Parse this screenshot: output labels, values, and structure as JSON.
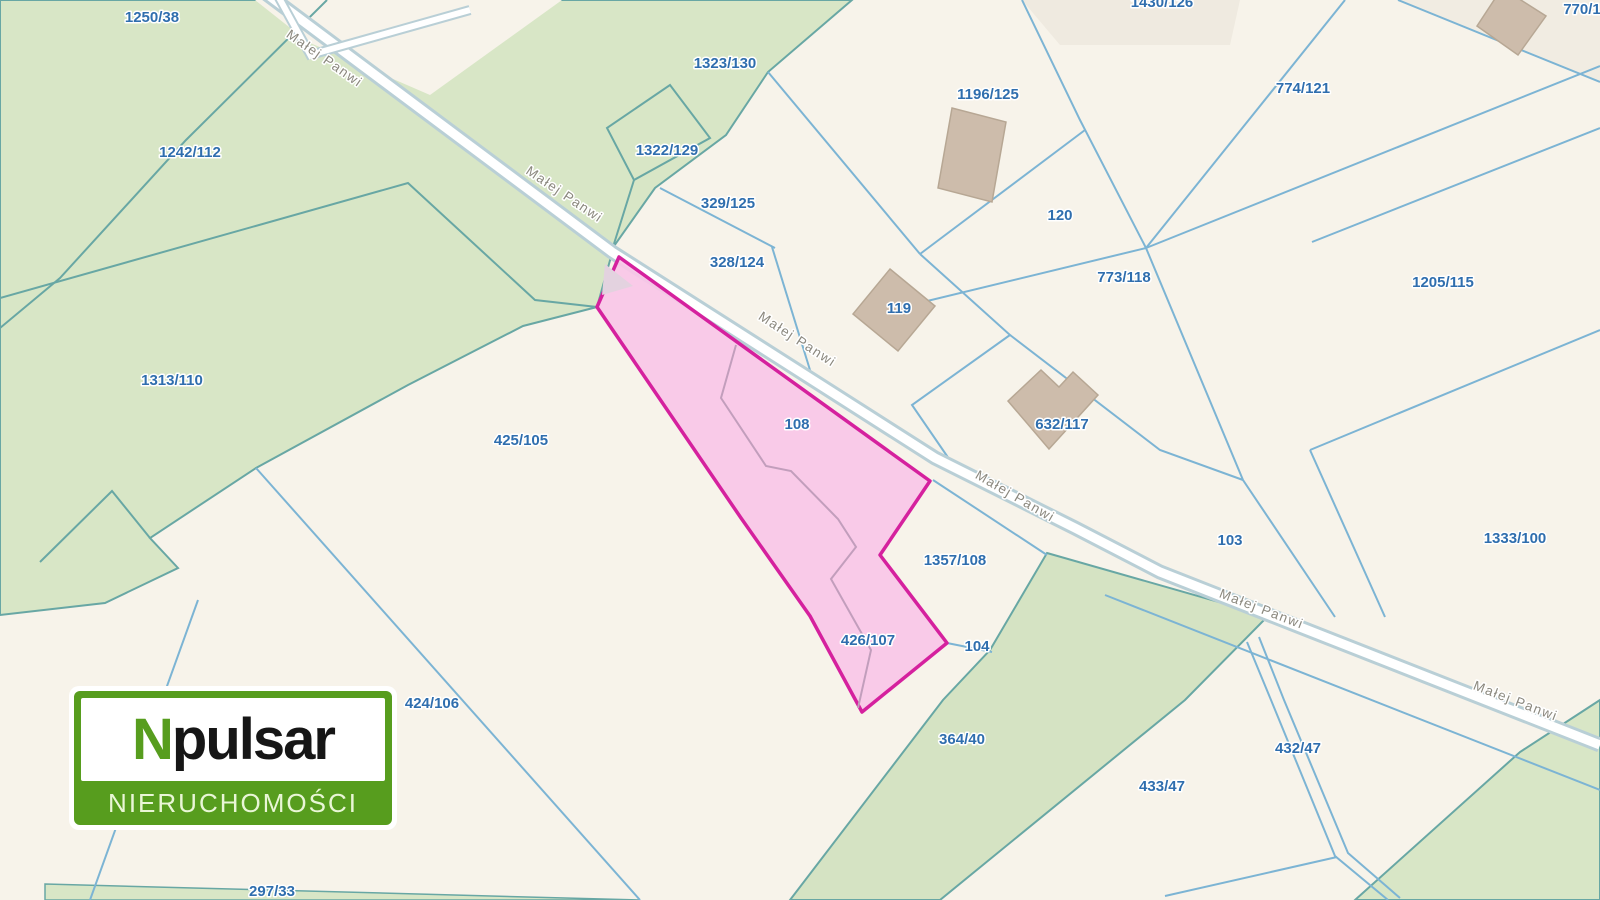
{
  "map": {
    "road_name": "Małej Panwi",
    "parcels": {
      "p1250_38": "1250/38",
      "p1242_112": "1242/112",
      "p1313_110": "1313/110",
      "p1323_130": "1323/130",
      "p1322_129": "1322/129",
      "p329_125": "329/125",
      "p328_124": "328/124",
      "p1196_125": "1196/125",
      "p1430_126": "1430/126",
      "p770_1": "770/1",
      "p774_121": "774/121",
      "p120": "120",
      "p773_118": "773/118",
      "p1205_115": "1205/115",
      "p119": "119",
      "p632_117": "632/117",
      "p108": "108",
      "p425_105": "425/105",
      "p1357_108": "1357/108",
      "p103": "103",
      "p1333_100": "1333/100",
      "p426_107": "426/107",
      "p104": "104",
      "p424_106": "424/106",
      "p364_40": "364/40",
      "p433_47": "433/47",
      "p432_47": "432/47",
      "p297_33": "297/33"
    },
    "highlighted_parcels": [
      "108",
      "426/107"
    ],
    "colors": {
      "highlight_fill": "#f8c7e7",
      "highlight_border": "#d5219e",
      "green_area": "#d8e6c6",
      "cream_area": "#f7f3ea",
      "parcel_line_blue": "#7cb4d4",
      "parcel_line_teal": "#68a7a4",
      "label_blue": "#2f6eae",
      "road_label_gray": "#8b887e",
      "building_fill": "#cdbcab",
      "road_fill": "#ffffff",
      "logo_green": "#579d1e"
    }
  },
  "logo": {
    "brand_prefix": "N",
    "brand_rest": "pulsar",
    "tagline": "NIERUCHOMOŚCI"
  }
}
